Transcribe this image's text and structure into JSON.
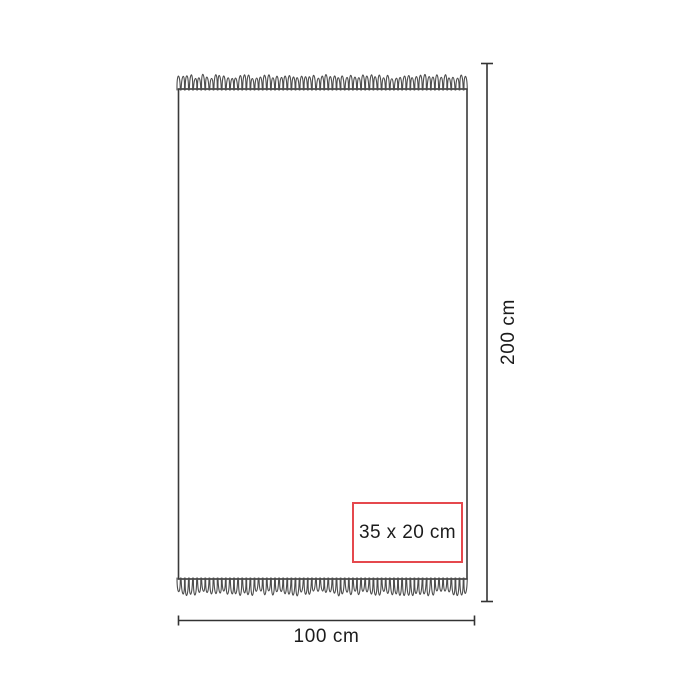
{
  "diagram": {
    "type": "product-dimensions",
    "subject": "towel-with-fringed-edges",
    "height_label": "200 cm",
    "width_label": "100 cm",
    "print_area_label": "35 x 20 cm",
    "colors": {
      "background": "#ffffff",
      "outline": "#3a3a3a",
      "fringe": "#4d4d4d",
      "dimension_line": "#333333",
      "print_area_border": "#e5484d",
      "text": "#1c1c1c"
    }
  }
}
